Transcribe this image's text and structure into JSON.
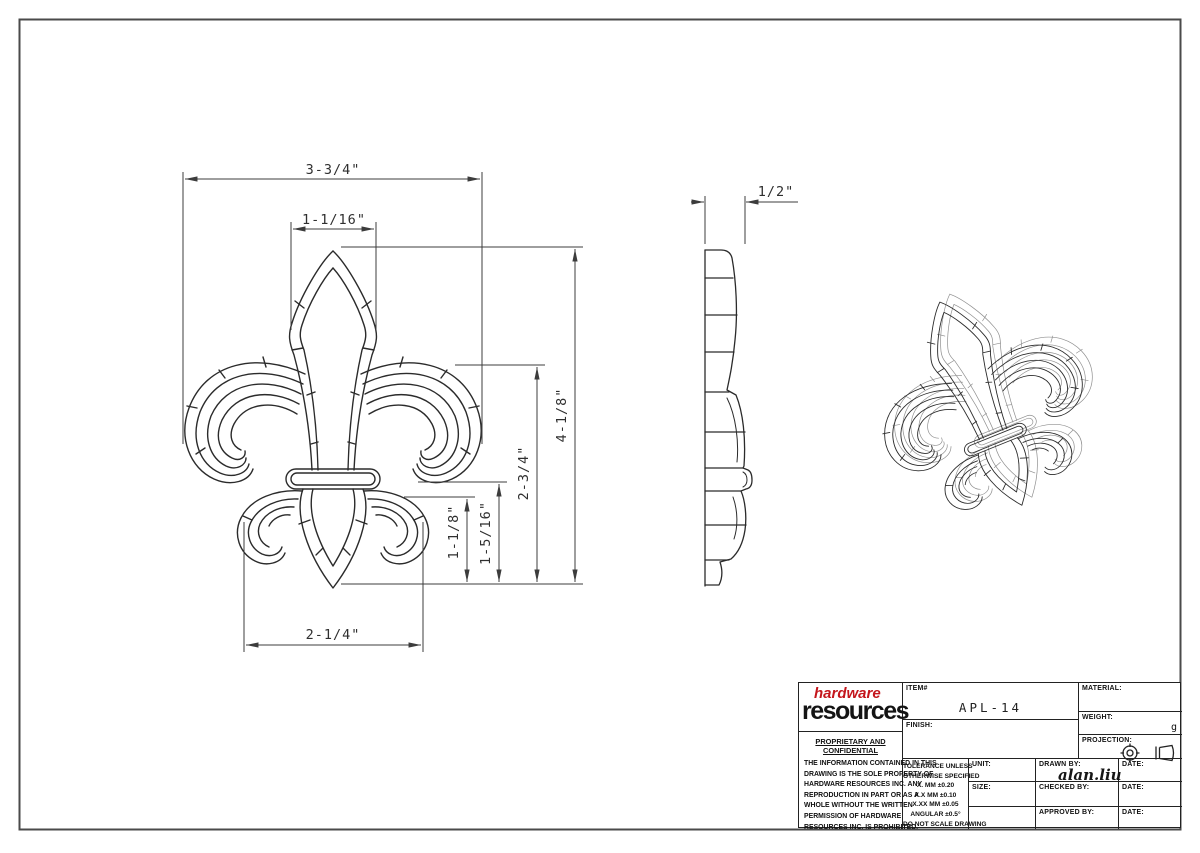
{
  "sheet": {
    "item_number": "APL-14",
    "type": "technical drawing"
  },
  "dimensions": {
    "overall_width": "3-3/4\"",
    "head_width": "1-1/16\"",
    "depth": "1/2\"",
    "overall_height": "4-1/8\"",
    "upper_height": "2-3/4\"",
    "lower_height_outer": "1-5/16\"",
    "lower_height_inner": "1-1/8\"",
    "base_width": "2-1/4\""
  },
  "title_block": {
    "logo": {
      "word1": "hardware",
      "word2": "resources"
    },
    "proprietary": {
      "heading": "PROPRIETARY AND CONFIDENTIAL",
      "lines": [
        "THE INFORMATION CONTAINED IN THIS",
        "DRAWING IS THE SOLE PROPERTY OF",
        "HARDWARE RESOURCES INC.  ANY",
        "REPRODUCTION IN PART OR AS A",
        "WHOLE  WITHOUT THE WRITTEN",
        "PERMISSION OF HARDWARE",
        "RESOURCES INC. IS PROHIBITED."
      ]
    },
    "item": {
      "label": "ITEM#",
      "value": "APL-14"
    },
    "finish": {
      "label": "FINISH:"
    },
    "material": {
      "label": "MATERIAL:"
    },
    "weight": {
      "label": "WEIGHT:",
      "unit": "g"
    },
    "projection": {
      "label": "PROJECTION:"
    },
    "tolerance": {
      "lines": [
        "TOLERANCE UNLESS",
        "OTHERWISE SPECIFIED",
        "X.    MM    ±0.20",
        "X.X   MM    ±0.10",
        "X.XX  MM   ±0.05",
        "ANGULAR     ±0.5°",
        "DO NOT SCALE DRAWING"
      ]
    },
    "unit": {
      "label": "UNIT:"
    },
    "size": {
      "label": "SIZE:"
    },
    "drawn": {
      "label": "DRAWN BY:",
      "value": "alan.liu"
    },
    "checked": {
      "label": "CHECKED BY:"
    },
    "approved": {
      "label": "APPROVED BY:"
    },
    "date_label": "DATE:"
  },
  "colors": {
    "line": "#2b2b2b",
    "dimension": "#3c3c3c",
    "logo_red": "#c4161c"
  }
}
